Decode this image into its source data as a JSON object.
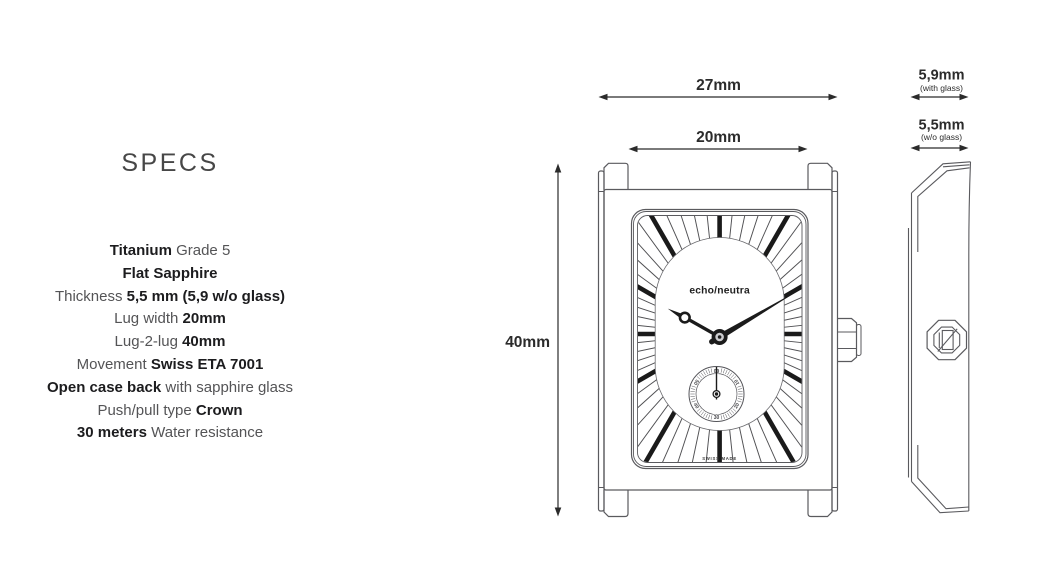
{
  "specs": {
    "heading": "SPECS",
    "items": [
      {
        "pre": "",
        "bold": "Titanium",
        "post": " Grade 5"
      },
      {
        "pre": "",
        "bold": "Flat Sapphire",
        "post": ""
      },
      {
        "pre": "Thickness ",
        "bold": "5,5 mm (5,9 w/o glass)",
        "post": ""
      },
      {
        "pre": "Lug width ",
        "bold": "20mm",
        "post": ""
      },
      {
        "pre": "Lug-2-lug ",
        "bold": "40mm",
        "post": ""
      },
      {
        "pre": "Movement ",
        "bold": "Swiss ETA 7001",
        "post": ""
      },
      {
        "pre": "",
        "bold": "Open case back",
        "post": " with sapphire glass"
      },
      {
        "pre": "Push/pull type ",
        "bold": "Crown",
        "post": ""
      },
      {
        "pre": "",
        "bold": "30 meters",
        "post": " Water resistance"
      }
    ]
  },
  "dimensions": {
    "case_width": "27mm",
    "lug_width": "20mm",
    "lug_to_lug": "40mm",
    "thickness_with_glass": {
      "value": "5,9mm",
      "note": "(with glass)"
    },
    "thickness_without_glass": {
      "value": "5,5mm",
      "note": "(w/o glass)"
    }
  },
  "watch": {
    "brand": "echo/neutra",
    "origin_label": "SWISS MADE",
    "subdial_numerals": [
      "60",
      "10",
      "20",
      "30",
      "40",
      "50"
    ]
  },
  "colors": {
    "ink": "#2b2b2b",
    "line": "#5a5a5e",
    "marker": "#1b1b1b",
    "bold_text": "#1c1c1e",
    "body_text": "#545456"
  }
}
